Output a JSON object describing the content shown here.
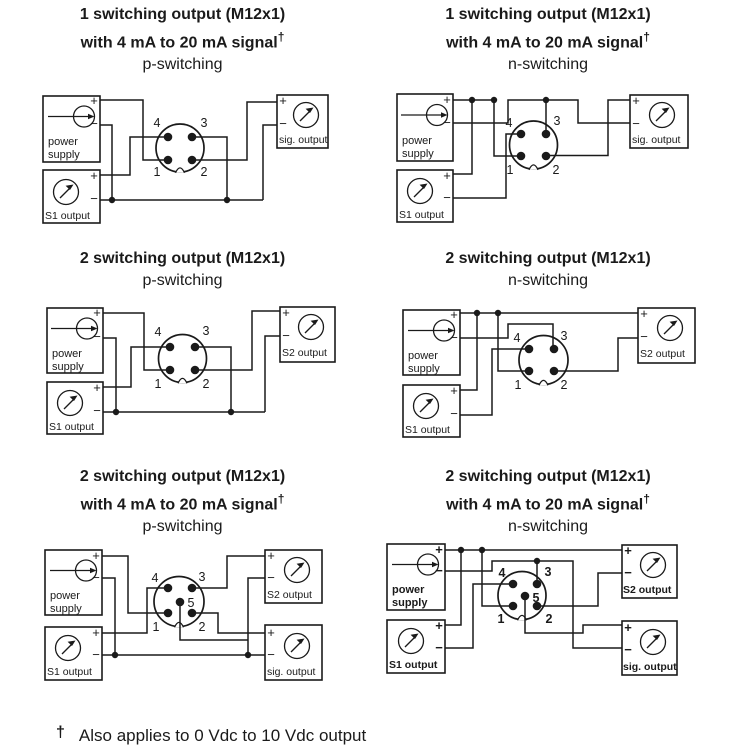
{
  "labels": {
    "power_line1": "power",
    "power_line2": "supply",
    "s1": "S1 output",
    "s2": "S2 output",
    "sig": "sig. output",
    "plus": "+",
    "minus": "−",
    "dagger": "†"
  },
  "pins": {
    "p1": "1",
    "p2": "2",
    "p3": "3",
    "p4": "4",
    "p5": "5"
  },
  "panels": [
    {
      "lines": [
        "1 switching output (M12x1)",
        "with 4 mA to 20 mA signal"
      ],
      "mode": "p-switching"
    },
    {
      "lines": [
        "1 switching output (M12x1)",
        "with 4 mA to 20 mA signal"
      ],
      "mode": "n-switching"
    },
    {
      "lines": [
        "2 switching output (M12x1)"
      ],
      "mode": "p-switching"
    },
    {
      "lines": [
        "2 switching output (M12x1)"
      ],
      "mode": "n-switching"
    },
    {
      "lines": [
        "2 switching output (M12x1)",
        "with 4 mA to 20 mA signal"
      ],
      "mode": "p-switching"
    },
    {
      "lines": [
        "2 switching output (M12x1)",
        "with 4 mA to 20 mA signal"
      ],
      "mode": "n-switching"
    }
  ],
  "footnote": {
    "symbol": "†",
    "text": "Also applies to 0 Vdc to 10 Vdc output"
  }
}
